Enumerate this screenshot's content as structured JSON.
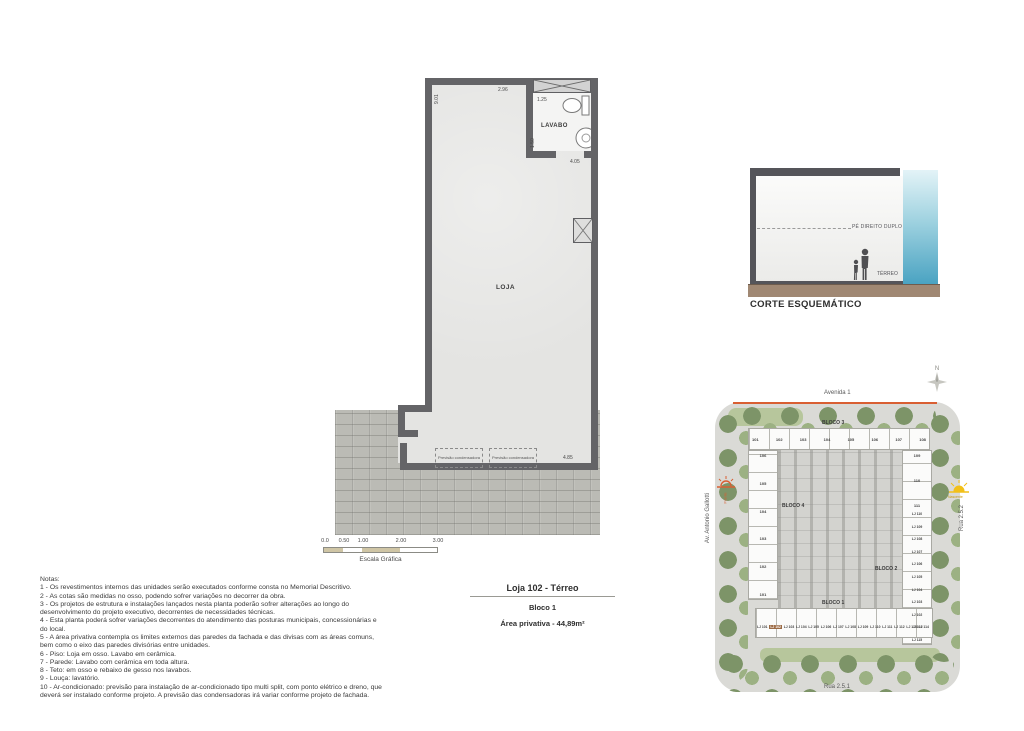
{
  "floor_plan": {
    "loja_label": "LOJA",
    "lavabo_label": "LAVABO",
    "dim_left": "9.01",
    "dim_top": "2.96",
    "dim_lavabo_width": "1.25",
    "dim_lavabo_height": "1.50",
    "dim_lavabo_bottom": "4.05",
    "dim_bottom": "4.85",
    "condenser_label": "Previsão condensadora"
  },
  "scale_bar": {
    "ticks": [
      "0.0",
      "0.50",
      "1.00",
      "2.00",
      "3.00"
    ],
    "label": "Escala Gráfica"
  },
  "corte": {
    "title": "CORTE ESQUEMÁTICO",
    "pe_direito": "PÉ DIREITO DUPLO",
    "terreo": "TÉRREO"
  },
  "site_plan": {
    "north": "N",
    "streets": {
      "top": "Avenida 1",
      "left": "Av. Antonio Gallotti",
      "right": "Rua 2.5.2",
      "bottom": "Rua 2.5.1"
    },
    "sun_left": "Poente",
    "sun_right": "Nascente",
    "blocks": {
      "b1": "BLOCO 1",
      "b2": "BLOCO 2",
      "b3": "BLOCO 3",
      "b4": "BLOCO 4"
    },
    "top_row": [
      "101",
      "102",
      "103",
      "104",
      "105",
      "106",
      "107",
      "108"
    ],
    "left_col": [
      "106",
      "105",
      "104",
      "103",
      "102",
      "101"
    ],
    "right_col_top": [
      "109",
      "110",
      "111"
    ],
    "right_col": [
      "LJ 110",
      "LJ 109",
      "LJ 108",
      "LJ 107",
      "LJ 106",
      "LJ 105",
      "LJ 104",
      "LJ 103",
      "LJ 102",
      "LJ 101",
      "LJ 115"
    ],
    "bottom_row": [
      "LJ 101",
      "LJ 102",
      "LJ 103",
      "LJ 104",
      "LJ 105",
      "LJ 106",
      "LJ 107",
      "LJ 108",
      "LJ 109",
      "LJ 110",
      "LJ 111",
      "LJ 112",
      "LJ 113",
      "LJ 114"
    ]
  },
  "title_block": {
    "line1": "Loja 102 - Térreo",
    "line2": "Bloco 1",
    "line3": "Área privativa - 44,89m²"
  },
  "notes": {
    "header": "Notas:",
    "items": [
      "1 - Os revestimentos internos das unidades serão executados conforme consta no Memorial Descritivo.",
      "2 - As cotas são medidas no osso, podendo sofrer variações no decorrer da obra.",
      "3 - Os projetos de estrutura e instalações lançados nesta planta poderão sofrer alterações ao longo do desenvolvimento do projeto executivo, decorrentes de necessidades técnicas.",
      "4 - Esta planta poderá sofrer variações decorrentes do atendimento das posturas municipais, concessionárias e do local.",
      "5 - A área privativa contempla os limites externos das paredes da fachada e das divisas com as áreas comuns, bem como o eixo das paredes divisórias entre unidades.",
      "6 - Piso: Loja em osso. Lavabo em cerâmica.",
      "7 - Parede: Lavabo com cerâmica em toda altura.",
      "8 - Teto: em osso e rebaixo de gesso nos lavabos.",
      "9 - Louça: lavatório.",
      "10 - Ar-condicionado: previsão para instalação de ar-condicionado tipo multi split, com ponto elétrico e dreno, que deverá ser instalado conforme projeto. A previsão das condensadoras irá variar conforme projeto de fachada."
    ]
  }
}
